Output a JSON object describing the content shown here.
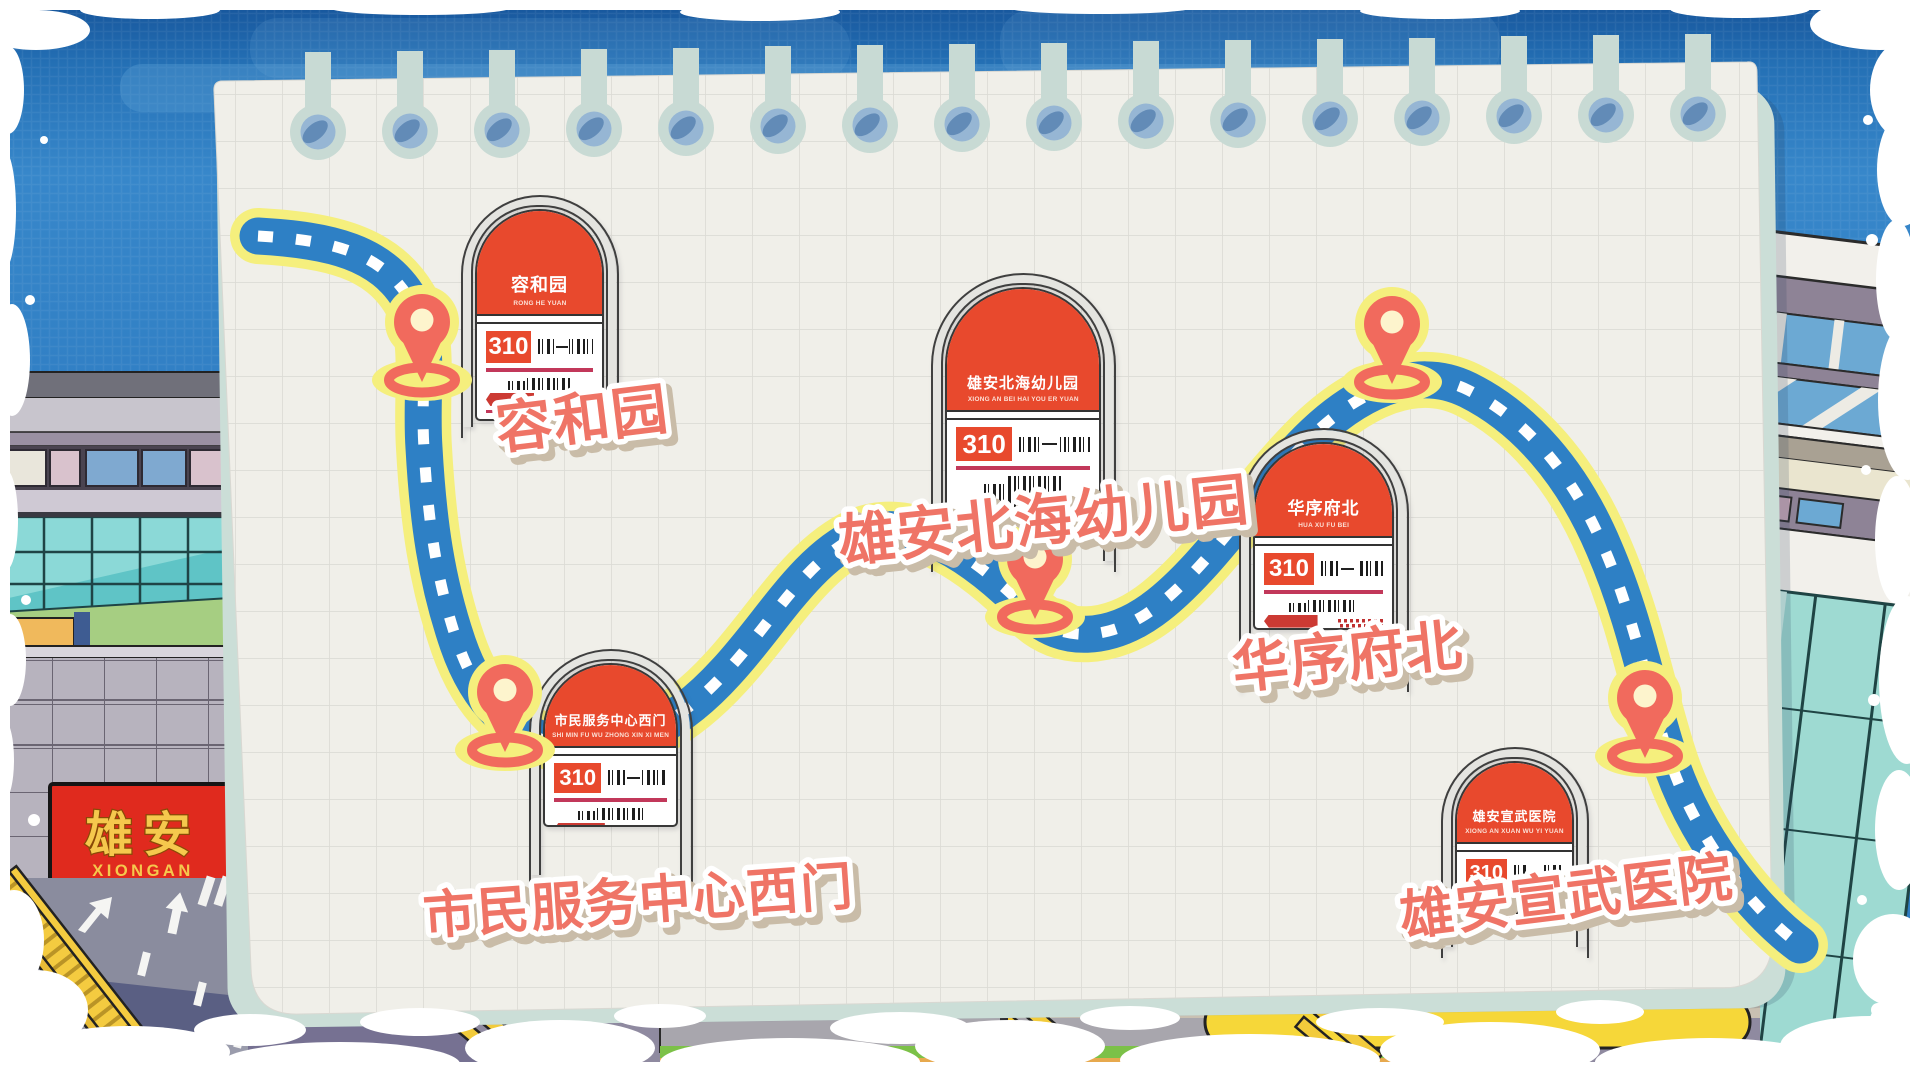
{
  "landmark_sign": {
    "cn": "雄安",
    "en": "XIONGAN"
  },
  "route": {
    "number": "310"
  },
  "stops": [
    {
      "name": "容和园",
      "pinyin": "RONG HE YUAN",
      "route": "310",
      "label": "容和园"
    },
    {
      "name": "雄安北海幼儿园",
      "pinyin": "XIONG AN BEI HAI YOU ER YUAN",
      "route": "310",
      "label": "雄安北海幼儿园"
    },
    {
      "name": "华序府北",
      "pinyin": "HUA XU FU BEI",
      "route": "310",
      "label": "华序府北"
    },
    {
      "name": "市民服务中心西门",
      "pinyin": "SHI MIN FU WU ZHONG XIN XI MEN",
      "route": "310",
      "label": "市民服务中心西门"
    },
    {
      "name": "雄安宣武医院",
      "pinyin": "XIONG AN XUAN WU YI YUAN",
      "route": "310",
      "label": "雄安宣武医院"
    }
  ],
  "colors": {
    "sky": "#2E7CC2",
    "paper": "#F0EFE9",
    "route_blue": "#2E80C5",
    "route_outline_yellow": "#F5EF7D",
    "pin_coral": "#F16A5D",
    "sign_header_red": "#E8492D",
    "label_coral": "#EF7466",
    "crimson_line": "#C2385A",
    "landmark_red": "#E02A1E",
    "landmark_gold": "#F5C84D"
  }
}
